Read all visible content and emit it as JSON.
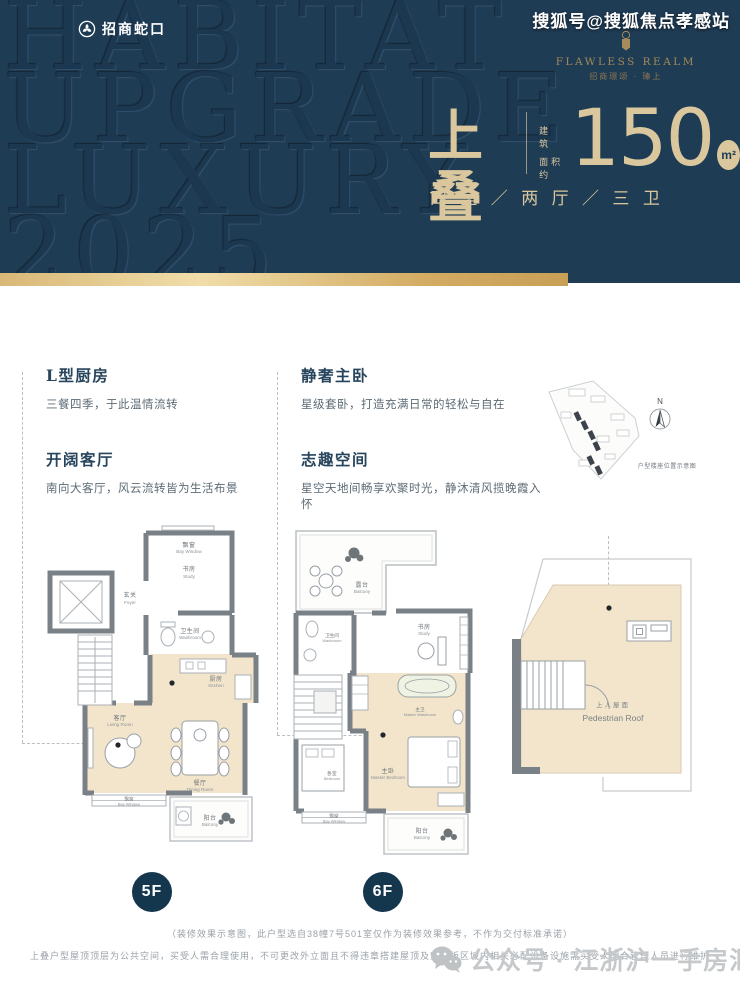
{
  "header": {
    "brand": {
      "name": "招商蛇口"
    },
    "watermark_lines": [
      "HABITAT",
      "UPGRADE",
      "LUXURY",
      "2025"
    ],
    "photo_credit": "搜狐号@搜狐焦点孝感站",
    "emblem": {
      "title": "FLAWLESS REALM",
      "subtitle": "招商璟颂 · 瑧上"
    },
    "headline": {
      "type_name": "上叠",
      "area_label_1": "建 筑",
      "area_label_2": "面积约",
      "area_value": "150",
      "area_unit": "m²",
      "layout_spec": "四 室 ／ 两 厅 ／ 三 卫"
    }
  },
  "features": {
    "items": [
      {
        "title": "L型厨房",
        "desc": "三餐四季，于此温情流转"
      },
      {
        "title": "开阔客厅",
        "desc": "南向大客厅，风云流转皆为生活布景"
      },
      {
        "title": "静奢主卧",
        "desc": "星级套卧，打造充满日常的轻松与自在"
      },
      {
        "title": "志趣空间",
        "desc": "星空天地间畅享欢聚时光，静沐清风揽晚霞入怀"
      }
    ]
  },
  "siteplan": {
    "north": "N",
    "caption": "户型楼座位置示意图"
  },
  "plans": {
    "p5": {
      "badge": "5F",
      "rooms": {
        "foyer": {
          "zh": "玄关",
          "en": "Foyer"
        },
        "study": {
          "zh": "书房",
          "en": "Study"
        },
        "bay_top": {
          "zh": "飘窗",
          "en": "Bay Window"
        },
        "washroom": {
          "zh": "卫生间",
          "en": "Washroom"
        },
        "kitchen": {
          "zh": "厨房",
          "en": "Kitchen"
        },
        "living": {
          "zh": "客厅",
          "en": "Living Room"
        },
        "dining": {
          "zh": "餐厅",
          "en": "Dining Room"
        },
        "bay_bottom": {
          "zh": "飘窗",
          "en": "Bay Window"
        },
        "balcony": {
          "zh": "阳台",
          "en": "Balcony"
        }
      }
    },
    "p6": {
      "badge": "6F",
      "rooms": {
        "terrace": {
          "zh": "露台",
          "en": "Balcony"
        },
        "washroom": {
          "zh": "卫生间",
          "en": "Washroom"
        },
        "study": {
          "zh": "书房",
          "en": "Study"
        },
        "master_wash": {
          "zh": "主卫",
          "en": "Master Washroom"
        },
        "bedroom": {
          "zh": "卧室",
          "en": "Bedroom"
        },
        "master_bed": {
          "zh": "主卧",
          "en": "Master Bedroom"
        },
        "bay": {
          "zh": "飘窗",
          "en": "Bay Window"
        },
        "balcony": {
          "zh": "阳台",
          "en": "Balcony"
        }
      }
    },
    "roof": {
      "zh": "上人屋面",
      "en": "Pedestrian Roof"
    }
  },
  "footer": {
    "disclaimer_1": "（装修效果示意图，此户型选自38幢7号501室仅作为装修效果参考，不作为交付标准承诺）",
    "disclaimer_2": "上叠户型屋顶顶层为公共空间，买受人需合理使用，不可更改外立面且不得违章搭建屋顶及空调板区域内相关必配设备设施需买受人配合管理人员进行维护",
    "watermark": "公众号 · 江浙沪一手房汇总"
  },
  "colors": {
    "navy": "#1f3c55",
    "beige_text": "#dac79d",
    "gold_bar": "#d3ab62",
    "plan_floor": "#f3e5cb"
  }
}
